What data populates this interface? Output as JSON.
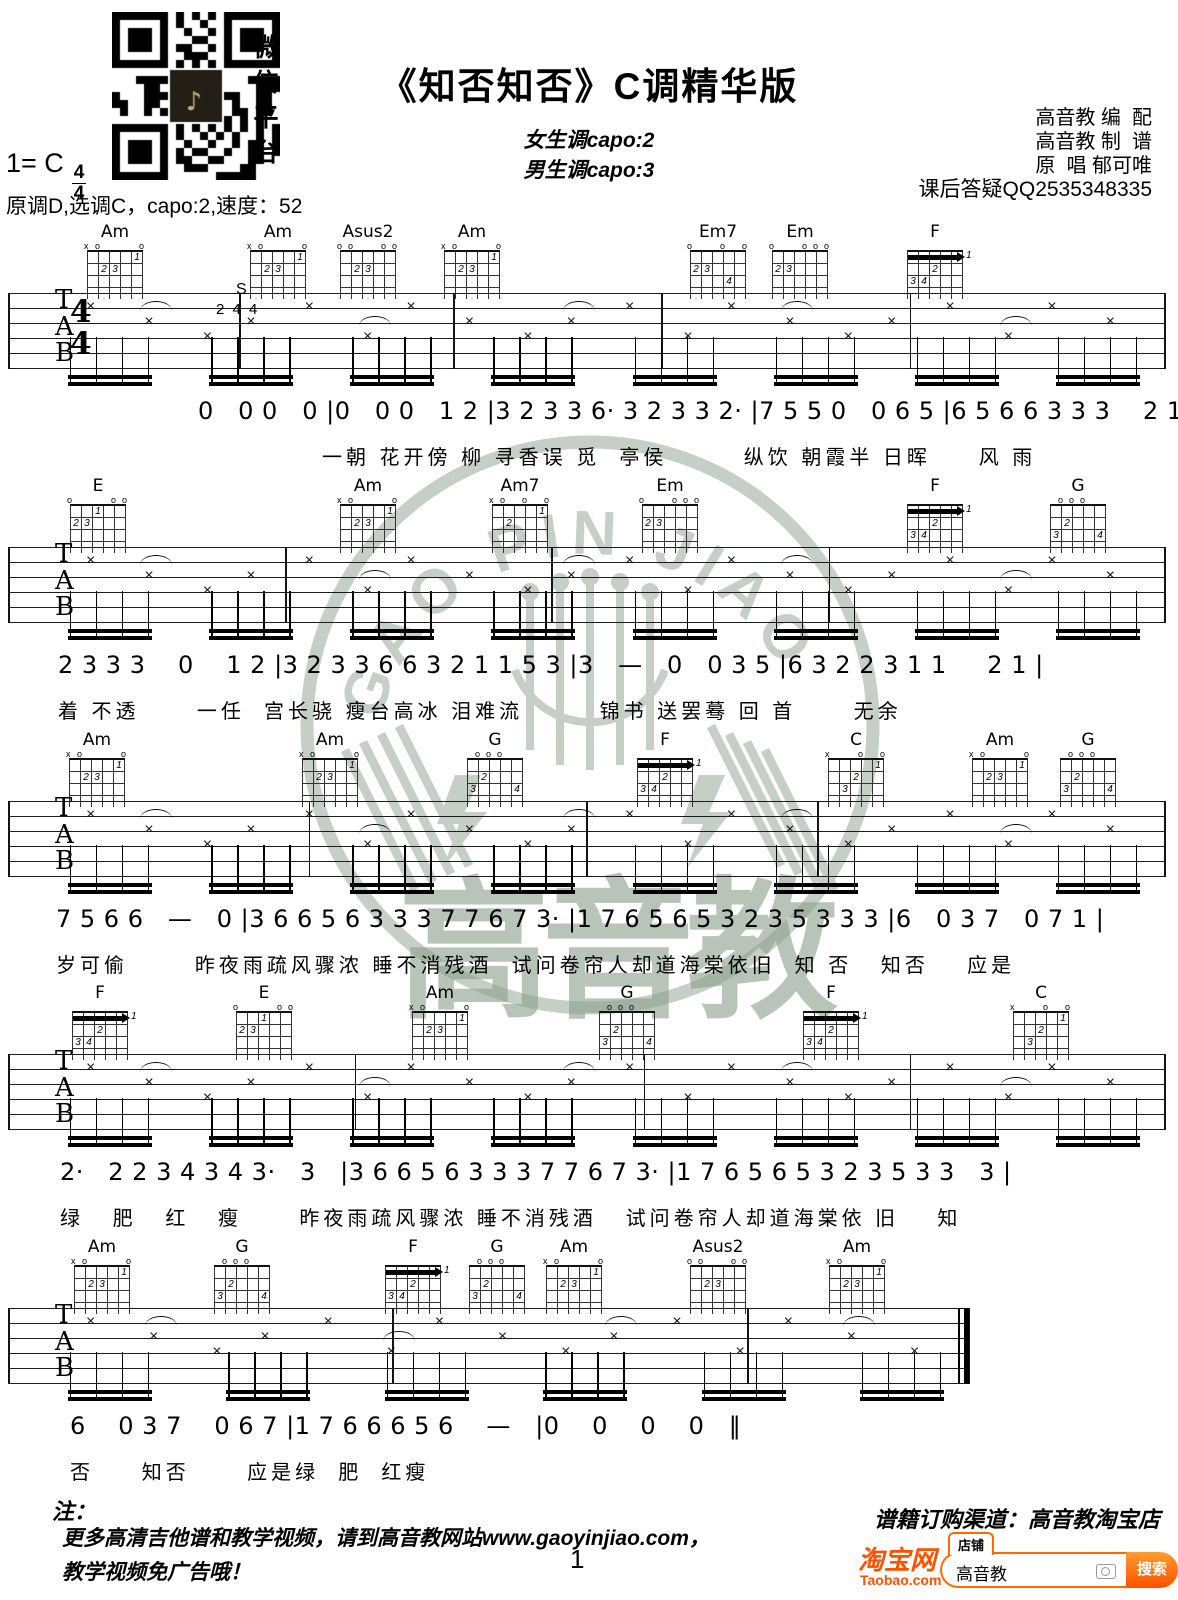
{
  "header": {
    "title": "《知否知否》C调精华版",
    "capo_female": "女生调capo:2",
    "capo_male": "男生调capo:3",
    "credit_arrange": "高音教 编  配",
    "credit_notate": "高音教 制  谱",
    "credit_singer": "原  唱 郁可唯",
    "credit_qq": "课后答疑QQ2535348335",
    "key_line": "1= C",
    "time_top": "4",
    "time_bottom": "4",
    "qr_caption": "微信平台",
    "tuning": "原调D,选调C，capo:2,速度：52"
  },
  "staff_labels": {
    "t": "T",
    "a": "A",
    "b": "B",
    "time_top": "4",
    "time_bottom": "4",
    "pattern_s": "S",
    "pattern_nums": "2 4 4"
  },
  "systems": [
    {
      "chords": [
        {
          "name": "Am",
          "x": 115
        },
        {
          "name": "Am",
          "x": 278
        },
        {
          "name": "Asus2",
          "x": 368
        },
        {
          "name": "Am",
          "x": 472
        },
        {
          "name": "Em7",
          "x": 718
        },
        {
          "name": "Em",
          "x": 800
        },
        {
          "name": "F",
          "x": 935
        }
      ],
      "numbers": "0   0 0   0 |0   0 0   1 2 |3 2 3 3 6· 3 2 3 3 2· |7 5 5 0   0 6 5 |6 5 6 6 3 3 3    2 1 1 |",
      "lyrics": "一朝 花开傍 柳 寻香误 觅  亭侯        纵饮 朝霞半 日晖     风 雨"
    },
    {
      "chords": [
        {
          "name": "E",
          "x": 98
        },
        {
          "name": "Am",
          "x": 368
        },
        {
          "name": "Am7",
          "x": 520
        },
        {
          "name": "Em",
          "x": 670
        },
        {
          "name": "F",
          "x": 935
        },
        {
          "name": "G",
          "x": 1078
        }
      ],
      "numbers": "2 3 3 3    0    1 2 |3 2 3 3 6 6 3 2 1 1 5 3 |3   —   0   0 3 5 |6 3 2 2 3 1 1     2 1 |",
      "lyrics": "着 不透      一任  宫长骁 瘦台高冰 泪难流        锦书 送罢蓦 回 首      无余"
    },
    {
      "chords": [
        {
          "name": "Am",
          "x": 97
        },
        {
          "name": "Am",
          "x": 330
        },
        {
          "name": "G",
          "x": 495
        },
        {
          "name": "F",
          "x": 665
        },
        {
          "name": "C",
          "x": 856
        },
        {
          "name": "Am",
          "x": 1000
        },
        {
          "name": "G",
          "x": 1088
        }
      ],
      "numbers": "7 5 6 6   —   0 |3 6 6 5 6 3 3 3 7 7 6 7 3· |1 7 6 5 6 5 3 2 3 5 3 3 3 |6   0 3 7   0 7 1 |",
      "lyrics": "岁可偷       昨夜雨疏风骤浓 睡不消残酒  试问卷帘人却道海棠依旧  知 否   知否    应是"
    },
    {
      "chords": [
        {
          "name": "F",
          "x": 100
        },
        {
          "name": "E",
          "x": 264
        },
        {
          "name": "Am",
          "x": 440
        },
        {
          "name": "G",
          "x": 627
        },
        {
          "name": "F",
          "x": 831
        },
        {
          "name": "C",
          "x": 1041
        }
      ],
      "numbers": "2·   2 2 3 4 3 4 3·   3   |3 6 6 5 6 3 3 3 7 7 6 7 3· |1 7 6 5 6 5 3 2 3 5 3 3   3 |",
      "lyrics": "绿   肥   红   瘦      昨夜雨疏风骤浓 睡不消残酒   试问卷帘人却道海棠依 旧    知"
    },
    {
      "chords": [
        {
          "name": "Am",
          "x": 102
        },
        {
          "name": "G",
          "x": 242
        },
        {
          "name": "F",
          "x": 413
        },
        {
          "name": "G",
          "x": 497
        },
        {
          "name": "Am",
          "x": 574
        },
        {
          "name": "Asus2",
          "x": 718
        },
        {
          "name": "Am",
          "x": 857
        }
      ],
      "numbers": "6    0 3 7    0 6 7 |1 7 6 6 6 5 6    —   |0    0    0    0   ‖",
      "lyrics": "否     知否      应是绿  肥  红瘦"
    }
  ],
  "chord_shapes": {
    "Am": {
      "markers": "xo   o",
      "dots": [
        [
          1,
          4,
          "1"
        ],
        [
          2,
          1,
          "2"
        ],
        [
          2,
          2,
          "3"
        ]
      ]
    },
    "Asus2": {
      "markers": "oo  oo",
      "dots": [
        [
          2,
          1,
          "2"
        ],
        [
          2,
          2,
          "3"
        ]
      ]
    },
    "Em7": {
      "markers": "o  o o",
      "dots": [
        [
          2,
          0,
          "2"
        ],
        [
          2,
          1,
          "3"
        ],
        [
          3,
          3,
          "4"
        ]
      ]
    },
    "Em": {
      "markers": "o  ooo",
      "dots": [
        [
          2,
          0,
          "2"
        ],
        [
          2,
          1,
          "3"
        ]
      ]
    },
    "F": {
      "markers": "      ",
      "barre": true,
      "pos": "1",
      "dots": [
        [
          2,
          2,
          "2"
        ],
        [
          3,
          0,
          "3"
        ],
        [
          3,
          1,
          "4"
        ]
      ]
    },
    "E": {
      "markers": "o   oo",
      "dots": [
        [
          1,
          2,
          "1"
        ],
        [
          2,
          0,
          "2"
        ],
        [
          2,
          1,
          "3"
        ]
      ]
    },
    "Am7": {
      "markers": "xo o o",
      "dots": [
        [
          1,
          4,
          "1"
        ],
        [
          2,
          1,
          "2"
        ]
      ]
    },
    "G": {
      "markers": " ooo  ",
      "dots": [
        [
          2,
          1,
          "2"
        ],
        [
          3,
          0,
          "3"
        ],
        [
          3,
          4,
          "4"
        ]
      ]
    },
    "C": {
      "markers": "x  o o",
      "dots": [
        [
          1,
          4,
          "1"
        ],
        [
          2,
          2,
          "2"
        ],
        [
          3,
          1,
          "3"
        ]
      ]
    }
  },
  "watermark": {
    "arc_text": "GAO PIN JIAO",
    "brand": "高音教",
    "color": "#8ca08c"
  },
  "footer": {
    "note_label": "注：",
    "note_line1": "更多高清吉他谱和教学视频，请到高音教网站www.gaoyinjiao.com，",
    "note_line2": "教学视频免广告哦！",
    "page_number": "1",
    "order_channel": "谱籍订购渠道：高音教淘宝店",
    "taobao": {
      "logo_cn": "淘宝网",
      "logo_en": "Taobao.com",
      "tab": "店铺",
      "search_value": "高音教",
      "search_button": "搜索",
      "accent": "#ff5000"
    }
  }
}
